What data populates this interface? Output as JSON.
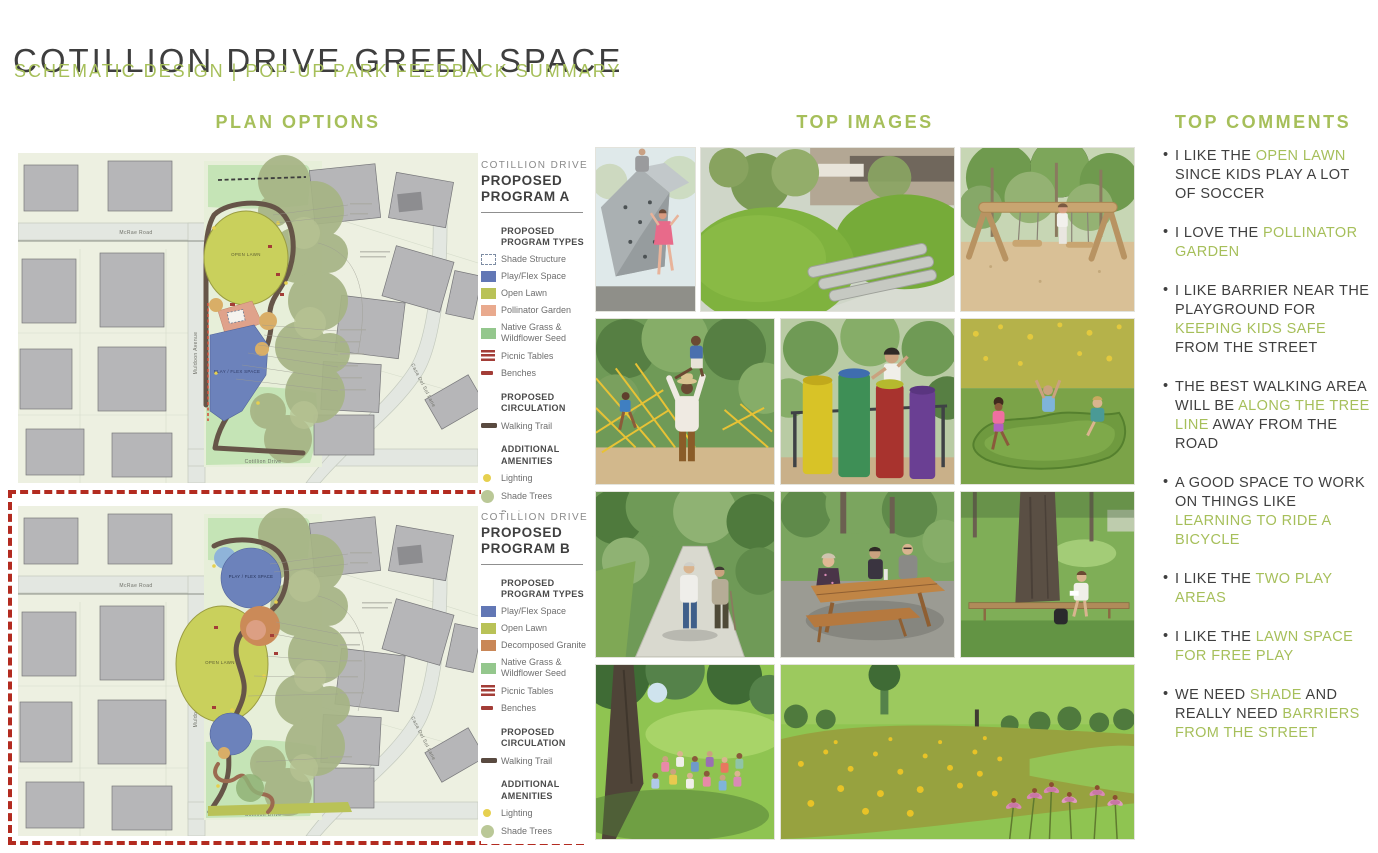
{
  "header": {
    "title": "COTILLION DRIVE GREEN SPACE",
    "subtitle": "SCHEMATIC DESIGN | POP-UP PARK FEEDBACK SUMMARY"
  },
  "columns": {
    "plan_options": "PLAN OPTIONS",
    "top_images": "TOP IMAGES",
    "top_comments": "TOP COMMENTS"
  },
  "colors": {
    "accent_green": "#a6bf5a",
    "title_gray": "#3e3e3e",
    "selection_red": "#b32b20",
    "play_flex_blue": "#6277b5",
    "open_lawn_olive": "#b9c257",
    "pollinator_salmon": "#e9aa8e",
    "native_grass_green": "#94c78d",
    "granite_orange": "#c98757",
    "picnic_red": "#a33d37",
    "trail_brown": "#594a40",
    "lighting_yellow": "#e6d04f",
    "shade_tree_sage": "#bac897",
    "barrier_orange": "#cf8a4e"
  },
  "map": {
    "street_top": "McRae Road",
    "street_left": "Muldoon Avenue",
    "street_right": "Casa Del Sol Lane",
    "street_bottom": "Cotillion Drive",
    "label_open_lawn": "OPEN LAWN",
    "label_play_flex": "PLAY / FLEX SPACE"
  },
  "plans": [
    {
      "id": "A",
      "selected": false,
      "legend": {
        "subtitle": "COTILLION DRIVE",
        "title": "PROPOSED PROGRAM A",
        "sections": [
          {
            "heading": "PROPOSED PROGRAM TYPES",
            "items": [
              {
                "label": "Shade Structure",
                "swatch": {
                  "type": "dashed"
                }
              },
              {
                "label": "Play/Flex Space",
                "swatch": {
                  "type": "rect",
                  "color": "#6277b5"
                }
              },
              {
                "label": "Open Lawn",
                "swatch": {
                  "type": "rect",
                  "color": "#b9c257"
                }
              },
              {
                "label": "Pollinator Garden",
                "swatch": {
                  "type": "rect",
                  "color": "#e9aa8e"
                }
              },
              {
                "label": "Native Grass & Wildflower Seed",
                "swatch": {
                  "type": "rect",
                  "color": "#94c78d"
                }
              },
              {
                "label": "Picnic Tables",
                "swatch": {
                  "type": "picnic",
                  "color": "#a33d37"
                }
              },
              {
                "label": "Benches",
                "swatch": {
                  "type": "bench",
                  "color": "#a33d37"
                }
              }
            ]
          },
          {
            "heading": "PROPOSED CIRCULATION",
            "items": [
              {
                "label": "Walking Trail",
                "swatch": {
                  "type": "trail",
                  "color": "#594a40"
                }
              }
            ]
          },
          {
            "heading": "ADDITIONAL AMENITIES",
            "items": [
              {
                "label": "Lighting",
                "swatch": {
                  "type": "dot",
                  "color": "#e6d04f"
                }
              },
              {
                "label": "Shade Trees",
                "swatch": {
                  "type": "tree",
                  "color": "#bac897"
                }
              },
              {
                "label": "Barrier",
                "swatch": {
                  "type": "dots",
                  "color": "#cf8a4e"
                }
              }
            ]
          }
        ]
      }
    },
    {
      "id": "B",
      "selected": true,
      "legend": {
        "subtitle": "COTILLION DRIVE",
        "title": "PROPOSED PROGRAM B",
        "sections": [
          {
            "heading": "PROPOSED PROGRAM TYPES",
            "items": [
              {
                "label": "Play/Flex Space",
                "swatch": {
                  "type": "rect",
                  "color": "#6277b5"
                }
              },
              {
                "label": "Open Lawn",
                "swatch": {
                  "type": "rect",
                  "color": "#b9c257"
                }
              },
              {
                "label": "Decomposed Granite",
                "swatch": {
                  "type": "rect",
                  "color": "#c98757"
                }
              },
              {
                "label": "Native Grass & Wildflower Seed",
                "swatch": {
                  "type": "rect",
                  "color": "#94c78d"
                }
              },
              {
                "label": "Picnic Tables",
                "swatch": {
                  "type": "picnic",
                  "color": "#a33d37"
                }
              },
              {
                "label": "Benches",
                "swatch": {
                  "type": "bench",
                  "color": "#a33d37"
                }
              }
            ]
          },
          {
            "heading": "PROPOSED CIRCULATION",
            "items": [
              {
                "label": "Walking Trail",
                "swatch": {
                  "type": "trail",
                  "color": "#594a40"
                }
              }
            ]
          },
          {
            "heading": "ADDITIONAL AMENITIES",
            "items": [
              {
                "label": "Lighting",
                "swatch": {
                  "type": "dot",
                  "color": "#e6d04f"
                }
              },
              {
                "label": "Shade Trees",
                "swatch": {
                  "type": "tree",
                  "color": "#bac897"
                }
              }
            ]
          }
        ]
      }
    }
  ],
  "photos": [
    {
      "name": "photo-climbing-boulder",
      "desc": "Children climbing a rock climbing boulder"
    },
    {
      "name": "photo-grass-mounds",
      "desc": "Grass mounds with log balance beams"
    },
    {
      "name": "photo-log-swing",
      "desc": "Girl playing on a timber swing structure"
    },
    {
      "name": "photo-father-child-playground",
      "desc": "Father lifting child at a net playground"
    },
    {
      "name": "photo-musical-tubes",
      "desc": "Boy playing colorful musical chime tubes"
    },
    {
      "name": "photo-green-spinner",
      "desc": "Kids spinning on a green saucer spinner"
    },
    {
      "name": "photo-trail-walkers",
      "desc": "Two people walking on a wooded trail"
    },
    {
      "name": "photo-picnic-table",
      "desc": "People sitting at a wooden picnic table"
    },
    {
      "name": "photo-bench-under-tree",
      "desc": "Person reading on a bench under a large tree"
    },
    {
      "name": "photo-lawn-gathering",
      "desc": "Group gathered on a lawn under a shade tree"
    },
    {
      "name": "photo-wildflower-meadow",
      "desc": "Wildflower meadow with coneflowers beside a lawn"
    }
  ],
  "comments": [
    {
      "segments": [
        {
          "t": "I LIKE THE ",
          "h": false
        },
        {
          "t": "OPEN LAWN",
          "h": true
        },
        {
          "t": " SINCE KIDS PLAY A LOT OF SOCCER",
          "h": false
        }
      ]
    },
    {
      "segments": [
        {
          "t": "I LOVE THE ",
          "h": false
        },
        {
          "t": "POLLINATOR GARDEN",
          "h": true
        }
      ]
    },
    {
      "segments": [
        {
          "t": "I LIKE BARRIER NEAR THE PLAYGROUND FOR ",
          "h": false
        },
        {
          "t": "KEEPING KIDS SAFE",
          "h": true
        },
        {
          "t": " FROM THE STREET",
          "h": false
        }
      ]
    },
    {
      "segments": [
        {
          "t": "THE BEST WALKING AREA WILL BE ",
          "h": false
        },
        {
          "t": "ALONG THE TREE LINE",
          "h": true
        },
        {
          "t": " AWAY FROM THE ROAD",
          "h": false
        }
      ]
    },
    {
      "segments": [
        {
          "t": "A GOOD SPACE TO WORK ON THINGS LIKE ",
          "h": false
        },
        {
          "t": "LEARNING TO RIDE A BICYCLE",
          "h": true
        }
      ]
    },
    {
      "segments": [
        {
          "t": "I LIKE THE ",
          "h": false
        },
        {
          "t": "TWO PLAY AREAS",
          "h": true
        }
      ]
    },
    {
      "segments": [
        {
          "t": "I LIKE THE ",
          "h": false
        },
        {
          "t": "LAWN SPACE FOR FREE PLAY",
          "h": true
        }
      ]
    },
    {
      "segments": [
        {
          "t": "WE NEED ",
          "h": false
        },
        {
          "t": "SHADE",
          "h": true
        },
        {
          "t": " AND REALLY NEED ",
          "h": false
        },
        {
          "t": "BARRIERS FROM THE STREET",
          "h": true
        }
      ]
    }
  ]
}
